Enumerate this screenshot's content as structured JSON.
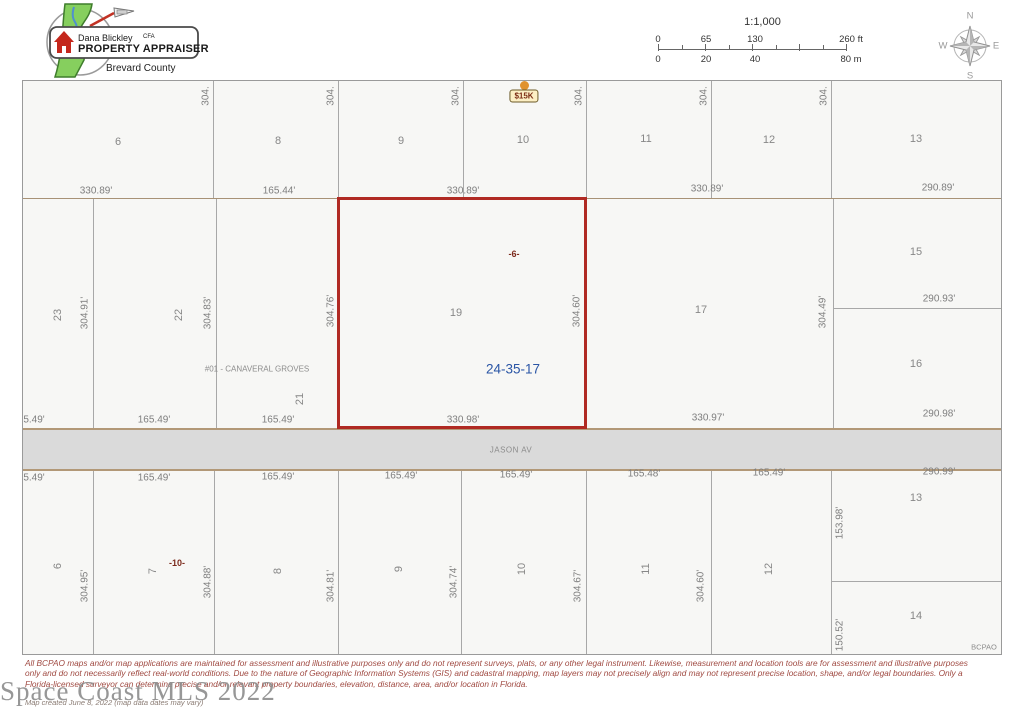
{
  "header": {
    "logo": {
      "name": "Dana Blickley",
      "cfa": "CFA",
      "title": "PROPERTY APPRAISER",
      "county": "Brevard County"
    },
    "scale": {
      "ratio": "1:1,000",
      "ft_ticks": [
        "0",
        "65",
        "130",
        "260 ft"
      ],
      "m_ticks": [
        "0",
        "20",
        "40",
        "80 m"
      ]
    },
    "compass": {
      "n": "N",
      "e": "E",
      "s": "S",
      "w": "W"
    }
  },
  "map": {
    "marker_label": "$15K",
    "street_name": "JASON AV",
    "subject": {
      "parcel_number": "19",
      "block_label": "-6-",
      "section_township_range": "24-35-17"
    },
    "credit": "BCPAO",
    "labels": [
      {
        "t": "6",
        "x": 117,
        "y": 141,
        "c": "num"
      },
      {
        "t": "8",
        "x": 277,
        "y": 140,
        "c": "num"
      },
      {
        "t": "9",
        "x": 400,
        "y": 140,
        "c": "num"
      },
      {
        "t": "10",
        "x": 522,
        "y": 139,
        "c": "num"
      },
      {
        "t": "11",
        "x": 645,
        "y": 138,
        "c": "num"
      },
      {
        "t": "12",
        "x": 768,
        "y": 139,
        "c": "num"
      },
      {
        "t": "13",
        "x": 915,
        "y": 138,
        "c": "num"
      },
      {
        "t": "304.",
        "x": 205,
        "y": 95,
        "r": 1,
        "c": "dim"
      },
      {
        "t": "304.",
        "x": 330,
        "y": 95,
        "r": 1,
        "c": "dim"
      },
      {
        "t": "304.",
        "x": 455,
        "y": 95,
        "r": 1,
        "c": "dim"
      },
      {
        "t": "304.",
        "x": 578,
        "y": 95,
        "r": 1,
        "c": "dim"
      },
      {
        "t": "304.",
        "x": 703,
        "y": 95,
        "r": 1,
        "c": "dim"
      },
      {
        "t": "304.",
        "x": 823,
        "y": 95,
        "r": 1,
        "c": "dim"
      },
      {
        "t": "330.89'",
        "x": 95,
        "y": 190,
        "c": "dim"
      },
      {
        "t": "165.44'",
        "x": 278,
        "y": 190,
        "c": "dim"
      },
      {
        "t": "330.89'",
        "x": 462,
        "y": 190,
        "c": "dim"
      },
      {
        "t": "330.89'",
        "x": 706,
        "y": 188,
        "c": "dim"
      },
      {
        "t": "290.89'",
        "x": 937,
        "y": 187,
        "c": "dim"
      },
      {
        "t": "23",
        "x": 57,
        "y": 314,
        "r": 1,
        "c": "num"
      },
      {
        "t": "304.91'",
        "x": 84,
        "y": 312,
        "r": 1,
        "c": "dim"
      },
      {
        "t": "22",
        "x": 178,
        "y": 314,
        "r": 1,
        "c": "num"
      },
      {
        "t": "304.83'",
        "x": 207,
        "y": 312,
        "r": 1,
        "c": "dim"
      },
      {
        "t": "#01 - CANAVERAL GROVES",
        "x": 256,
        "y": 368,
        "c": "tiny"
      },
      {
        "t": "21",
        "x": 299,
        "y": 398,
        "r": 1,
        "c": "num"
      },
      {
        "t": "304.76'",
        "x": 330,
        "y": 310,
        "r": 1,
        "c": "dim"
      },
      {
        "t": "304.60'",
        "x": 576,
        "y": 310,
        "r": 1,
        "c": "dim"
      },
      {
        "t": "17",
        "x": 700,
        "y": 309,
        "c": "num"
      },
      {
        "t": "304.49'",
        "x": 822,
        "y": 311,
        "r": 1,
        "c": "dim"
      },
      {
        "t": "15",
        "x": 915,
        "y": 251,
        "c": "num"
      },
      {
        "t": "290.93'",
        "x": 938,
        "y": 298,
        "c": "dim"
      },
      {
        "t": "16",
        "x": 915,
        "y": 363,
        "c": "num"
      },
      {
        "t": "5.49'",
        "x": 33,
        "y": 419,
        "c": "dim"
      },
      {
        "t": "165.49'",
        "x": 153,
        "y": 419,
        "c": "dim"
      },
      {
        "t": "165.49'",
        "x": 277,
        "y": 419,
        "c": "dim"
      },
      {
        "t": "330.98'",
        "x": 462,
        "y": 419,
        "c": "dim"
      },
      {
        "t": "330.97'",
        "x": 707,
        "y": 417,
        "c": "dim"
      },
      {
        "t": "290.98'",
        "x": 938,
        "y": 413,
        "c": "dim"
      },
      {
        "t": "5.49'",
        "x": 33,
        "y": 477,
        "c": "dim"
      },
      {
        "t": "165.49'",
        "x": 153,
        "y": 477,
        "c": "dim"
      },
      {
        "t": "165.49'",
        "x": 277,
        "y": 476,
        "c": "dim"
      },
      {
        "t": "165.49'",
        "x": 400,
        "y": 475,
        "c": "dim"
      },
      {
        "t": "165.49'",
        "x": 515,
        "y": 474,
        "c": "dim"
      },
      {
        "t": "165.48'",
        "x": 643,
        "y": 473,
        "c": "dim"
      },
      {
        "t": "165.49'",
        "x": 768,
        "y": 472,
        "c": "dim"
      },
      {
        "t": "290.99'",
        "x": 938,
        "y": 471,
        "c": "dim"
      },
      {
        "t": "6",
        "x": 57,
        "y": 565,
        "r": 1,
        "c": "num"
      },
      {
        "t": "304.95'",
        "x": 84,
        "y": 585,
        "r": 1,
        "c": "dim"
      },
      {
        "t": "7",
        "x": 152,
        "y": 570,
        "r": 1,
        "c": "num"
      },
      {
        "t": "-10-",
        "x": 176,
        "y": 562,
        "c": "red"
      },
      {
        "t": "304.88'",
        "x": 207,
        "y": 581,
        "r": 1,
        "c": "dim"
      },
      {
        "t": "8",
        "x": 277,
        "y": 570,
        "r": 1,
        "c": "num"
      },
      {
        "t": "304.81'",
        "x": 330,
        "y": 585,
        "r": 1,
        "c": "dim"
      },
      {
        "t": "9",
        "x": 398,
        "y": 568,
        "r": 1,
        "c": "num"
      },
      {
        "t": "304.74'",
        "x": 453,
        "y": 581,
        "r": 1,
        "c": "dim"
      },
      {
        "t": "10",
        "x": 521,
        "y": 568,
        "r": 1,
        "c": "num"
      },
      {
        "t": "304.67'",
        "x": 577,
        "y": 585,
        "r": 1,
        "c": "dim"
      },
      {
        "t": "11",
        "x": 645,
        "y": 568,
        "r": 1,
        "c": "num"
      },
      {
        "t": "304.60'",
        "x": 700,
        "y": 585,
        "r": 1,
        "c": "dim"
      },
      {
        "t": "12",
        "x": 768,
        "y": 568,
        "r": 1,
        "c": "num"
      },
      {
        "t": "153.98'",
        "x": 839,
        "y": 522,
        "r": 1,
        "c": "dim"
      },
      {
        "t": "13",
        "x": 915,
        "y": 497,
        "c": "num"
      },
      {
        "t": "150.52'",
        "x": 839,
        "y": 634,
        "r": 1,
        "c": "dim"
      },
      {
        "t": "14",
        "x": 915,
        "y": 615,
        "c": "num"
      }
    ]
  },
  "footer": {
    "disclaimer_lines": [
      "All BCPAO maps and/or map applications are maintained for assessment and illustrative purposes only and do not represent surveys, plats, or any other legal instrument. Likewise, measurement and location tools are for assessment and illustrative purposes",
      "only and do not necessarily reflect real-world conditions. Due to the nature of Geographic Information Systems (GIS) and cadastral mapping, map layers may not precisely align and may not represent precise location, shape, and/or legal boundaries. Only a",
      "Florida-licensed surveyor can determine precise and/or relevant property boundaries, elevation, distance, area, and/or location in Florida."
    ],
    "created": "Map created June 8, 2022 (map data dates may vary)",
    "watermark": "Space Coast MLS 2022"
  }
}
